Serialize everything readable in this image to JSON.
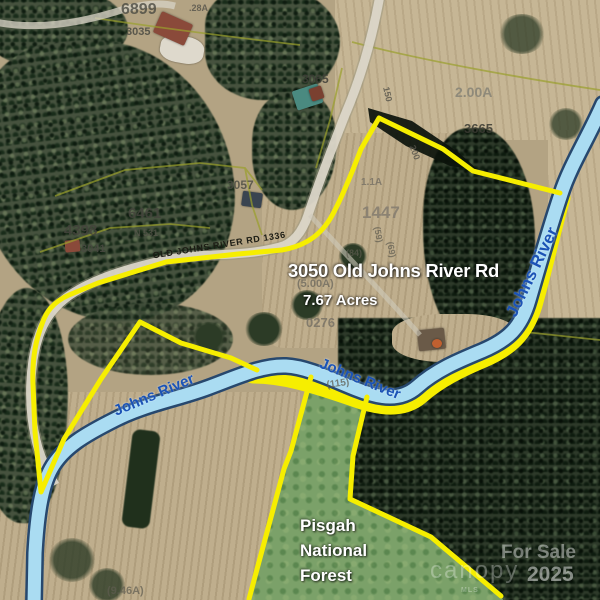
{
  "map": {
    "address_label": "3050 Old Johns River Rd",
    "acreage_label": "7.67 Acres",
    "road_label": "OLD JOHNS RIVER RD 1336",
    "river_label": "Johns River",
    "forest_label_lines": [
      "Pisgah",
      "National",
      "Forest"
    ],
    "river_label_instances": [
      {
        "cx": 532,
        "cy": 272,
        "rot": -64,
        "fs": 17
      },
      {
        "cx": 154,
        "cy": 395,
        "rot": -23,
        "fs": 15
      },
      {
        "cx": 360,
        "cy": 379,
        "rot": 22,
        "fs": 15
      }
    ],
    "parcel_labels": [
      {
        "t": "6899",
        "x": 121,
        "y": 2,
        "fs": 16,
        "c": "#4a4a42",
        "o": 0.8
      },
      {
        "t": ".28A",
        "x": 189,
        "y": 4,
        "fs": 9,
        "c": "#55534a",
        "o": 0.8
      },
      {
        "t": "3035",
        "x": 126,
        "y": 27,
        "fs": 11,
        "c": "#4a4a42",
        "o": 0.85
      },
      {
        "t": "3065",
        "x": 302,
        "y": 73,
        "fs": 12,
        "c": "#3f3f38",
        "o": 0.85
      },
      {
        "t": "2.00A",
        "x": 455,
        "y": 85,
        "fs": 14,
        "c": "#8a8678",
        "o": 0.9
      },
      {
        "t": "3665",
        "x": 464,
        "y": 122,
        "fs": 13,
        "c": "#3a3a32",
        "o": 0.85
      },
      {
        "t": "1.1A",
        "x": 361,
        "y": 178,
        "fs": 10,
        "c": "#7d7668",
        "o": 0.9
      },
      {
        "t": "1447",
        "x": 362,
        "y": 204,
        "fs": 17,
        "c": "#8a8172",
        "o": 0.95
      },
      {
        "t": "3057",
        "x": 227,
        "y": 179,
        "fs": 12,
        "c": "#4a4a42",
        "o": 0.8
      },
      {
        "t": "6461",
        "x": 128,
        "y": 206,
        "fs": 15,
        "c": "#44443c",
        "o": 0.85
      },
      {
        "t": "N 531",
        "x": 134,
        "y": 229,
        "fs": 9,
        "c": "#5a584e",
        "o": 0.7
      },
      {
        "t": "4398",
        "x": 64,
        "y": 223,
        "fs": 15,
        "c": "#44443c",
        "o": 0.85
      },
      {
        "t": "3041",
        "x": 81,
        "y": 244,
        "fs": 11,
        "c": "#4a4a42",
        "o": 0.85
      },
      {
        "t": "150",
        "x": 390,
        "y": 86,
        "fs": 9,
        "rot": 78,
        "c": "#55534a",
        "o": 0.8
      },
      {
        "t": "200",
        "x": 416,
        "y": 144,
        "fs": 9,
        "rot": 70,
        "c": "#55534a",
        "o": 0.8
      },
      {
        "t": "(84)",
        "x": 346,
        "y": 249,
        "fs": 9,
        "c": "#5f5c50",
        "o": 0.7
      },
      {
        "t": "(59)",
        "x": 381,
        "y": 226,
        "fs": 9,
        "rot": 80,
        "c": "#5f5c50",
        "o": 0.7
      },
      {
        "t": "(69)",
        "x": 394,
        "y": 241,
        "fs": 9,
        "rot": 80,
        "c": "#5f5c50",
        "o": 0.7
      },
      {
        "t": "(5.00A)",
        "x": 297,
        "y": 279,
        "fs": 11,
        "c": "#6a675c",
        "o": 0.75
      },
      {
        "t": "0276",
        "x": 306,
        "y": 316,
        "fs": 13,
        "c": "#7d7668",
        "o": 0.9
      },
      {
        "t": "(115)",
        "x": 326,
        "y": 381,
        "fs": 10,
        "rot": -8,
        "c": "#5f5c50",
        "o": 0.75
      },
      {
        "t": "(9.46A)",
        "x": 107,
        "y": 586,
        "fs": 11,
        "c": "#5f5c50",
        "o": 0.7
      }
    ]
  },
  "watermark": {
    "for_sale": "For Sale",
    "year": "2025",
    "brand": "canopy",
    "mls": "MLS"
  },
  "colors": {
    "boundary_yellow": "#f6ee00",
    "river_fill": "#aadcf2",
    "river_casing": "#27486e",
    "river_text_blue": "#1b53b6",
    "road_fill": "#ddd8cb"
  }
}
